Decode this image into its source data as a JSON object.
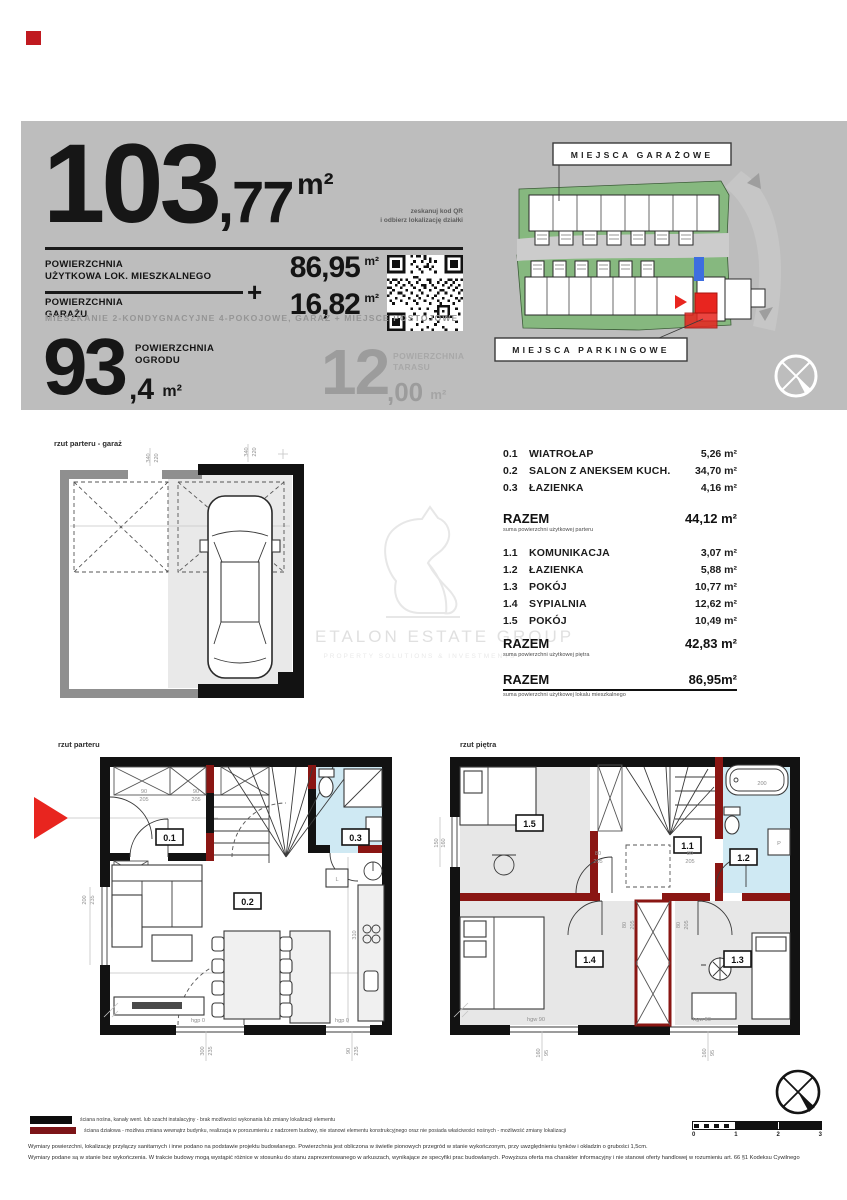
{
  "colors": {
    "highlight_red": "#e8251f",
    "parking_blue": "#3d6ee0",
    "bath_blue": "#cfe9f3",
    "site_green": "#86b87f",
    "wall_red": "#8a1613",
    "band_gray": "#bdbdbd"
  },
  "header": {
    "area_int": "103",
    "area_dec": ",77",
    "area_unit": "m²",
    "qr_note1": "zeskanuj kod QR",
    "qr_note2": "i odbierz lokalizację działki",
    "rows": [
      {
        "l1": "POWIERZCHNIA",
        "l2": "UŻYTKOWA LOK. MIESZKALNEGO",
        "v": "86,95",
        "u": "m²"
      },
      {
        "l1": "POWIERZCHNIA",
        "l2": "GARAŻU",
        "v": "16,82",
        "u": "m²"
      }
    ],
    "plus": "+",
    "subtitle": "MIESZKANIE 2-KONDYGNACYJNE 4-POKOJOWE, GARAŻ + MIEJSCE POSTOJOWE",
    "garden": {
      "int": "93",
      "dec": ",4",
      "unit": "m²",
      "l1": "POWIERZCHNIA",
      "l2": "OGRODU"
    },
    "terrace": {
      "int": "12",
      "dec": ",00",
      "unit": "m²",
      "l1": "POWIERZCHNIA",
      "l2": "TARASU"
    }
  },
  "siteplan": {
    "label_top": "MIEJSCA GARAŻOWE",
    "label_bottom": "MIEJSCA PARKINGOWE"
  },
  "plans": {
    "garage_label": "rzut parteru - garaż",
    "ground_label": "rzut parteru",
    "floor_label": "rzut piętra",
    "ground_rooms": [
      "0.1",
      "0.2",
      "0.3"
    ],
    "floor_rooms": [
      "1.1",
      "1.2",
      "1.3",
      "1.4",
      "1.5"
    ],
    "fridge": "L",
    "washer": "P",
    "garage_dims": [
      "340",
      "220",
      "340",
      "220"
    ],
    "ground_dims": [
      "90",
      "205",
      "90",
      "205",
      "200",
      "235",
      "hgp 0",
      "300",
      "235",
      "hgp 0",
      "90",
      "235",
      "310"
    ],
    "floor_dims": [
      "80",
      "205",
      "80",
      "205",
      "80",
      "205",
      "80",
      "205",
      "200",
      "150",
      "160",
      "hgw 90",
      "160",
      "95",
      "hgw 90",
      "160",
      "95"
    ]
  },
  "room_table": {
    "ground": [
      {
        "id": "0.1",
        "name": "WIATROŁAP",
        "area": "5,26 m²"
      },
      {
        "id": "0.2",
        "name": "SALON Z ANEKSEM KUCH.",
        "area": "34,70 m²"
      },
      {
        "id": "0.3",
        "name": "ŁAZIENKA",
        "area": "4,16 m²"
      }
    ],
    "ground_total": {
      "label": "RAZEM",
      "value": "44,12 m²",
      "sub": "suma powierzchni użytkowej parteru"
    },
    "floor": [
      {
        "id": "1.1",
        "name": "KOMUNIKACJA",
        "area": "3,07  m²"
      },
      {
        "id": "1.2",
        "name": "ŁAZIENKA",
        "area": "5,88  m²"
      },
      {
        "id": "1.3",
        "name": "POKÓJ",
        "area": "10,77 m²"
      },
      {
        "id": "1.4",
        "name": "SYPIALNIA",
        "area": "12,62 m²"
      },
      {
        "id": "1.5",
        "name": "POKÓJ",
        "area": "10,49 m²"
      }
    ],
    "floor_total": {
      "label": "RAZEM",
      "value": "42,83 m²",
      "sub": "suma powierzchni użytkowej piętra"
    },
    "grand_total": {
      "label": "RAZEM",
      "value": "86,95m²",
      "sub": "suma powierzchni użytkowej lokalu mieszkalnego"
    }
  },
  "watermark": {
    "title": "ETALON ESTATE GROUP",
    "subtitle": "PROPERTY SOLUTIONS & INVESTMENTS"
  },
  "footer": {
    "legend1": "ściana nośna, kanały went. lub szacht instalacyjny - brak możliwości wykonania lub zmiany lokalizacji elementu",
    "legend2": "ściana działowa - możliwa zmiana wewnątrz budynku, realizacja w porozumieniu z nadzorem budowy, nie stanowi elementu konstrukcyjnego oraz nie posiada właściwości nośnych - możliwość zmiany lokalizacji",
    "disc1": "Wymiary powierzchni, lokalizację przyłączy sanitarnych i inne podano na podstawie projektu budowlanego. Powierzchnia jest obliczona w świetle pionowych przegród w stanie wykończonym, przy uwzględnieniu tynków i okładzin o grubości 1,5cm.",
    "disc2": "Wymiary podane są w stanie bez wykończenia. W trakcie budowy mogą wystąpić różnice w stosunku do stanu zaprezentowanego w arkuszach, wynikające ze specyfiki prac budowlanych. Powyższa oferta ma charakter informacyjny i nie stanowi oferty handlowej w rozumieniu art. 66 §1 Kodeksu Cywilnego",
    "scale": [
      "0",
      "1",
      "2",
      "3"
    ]
  }
}
